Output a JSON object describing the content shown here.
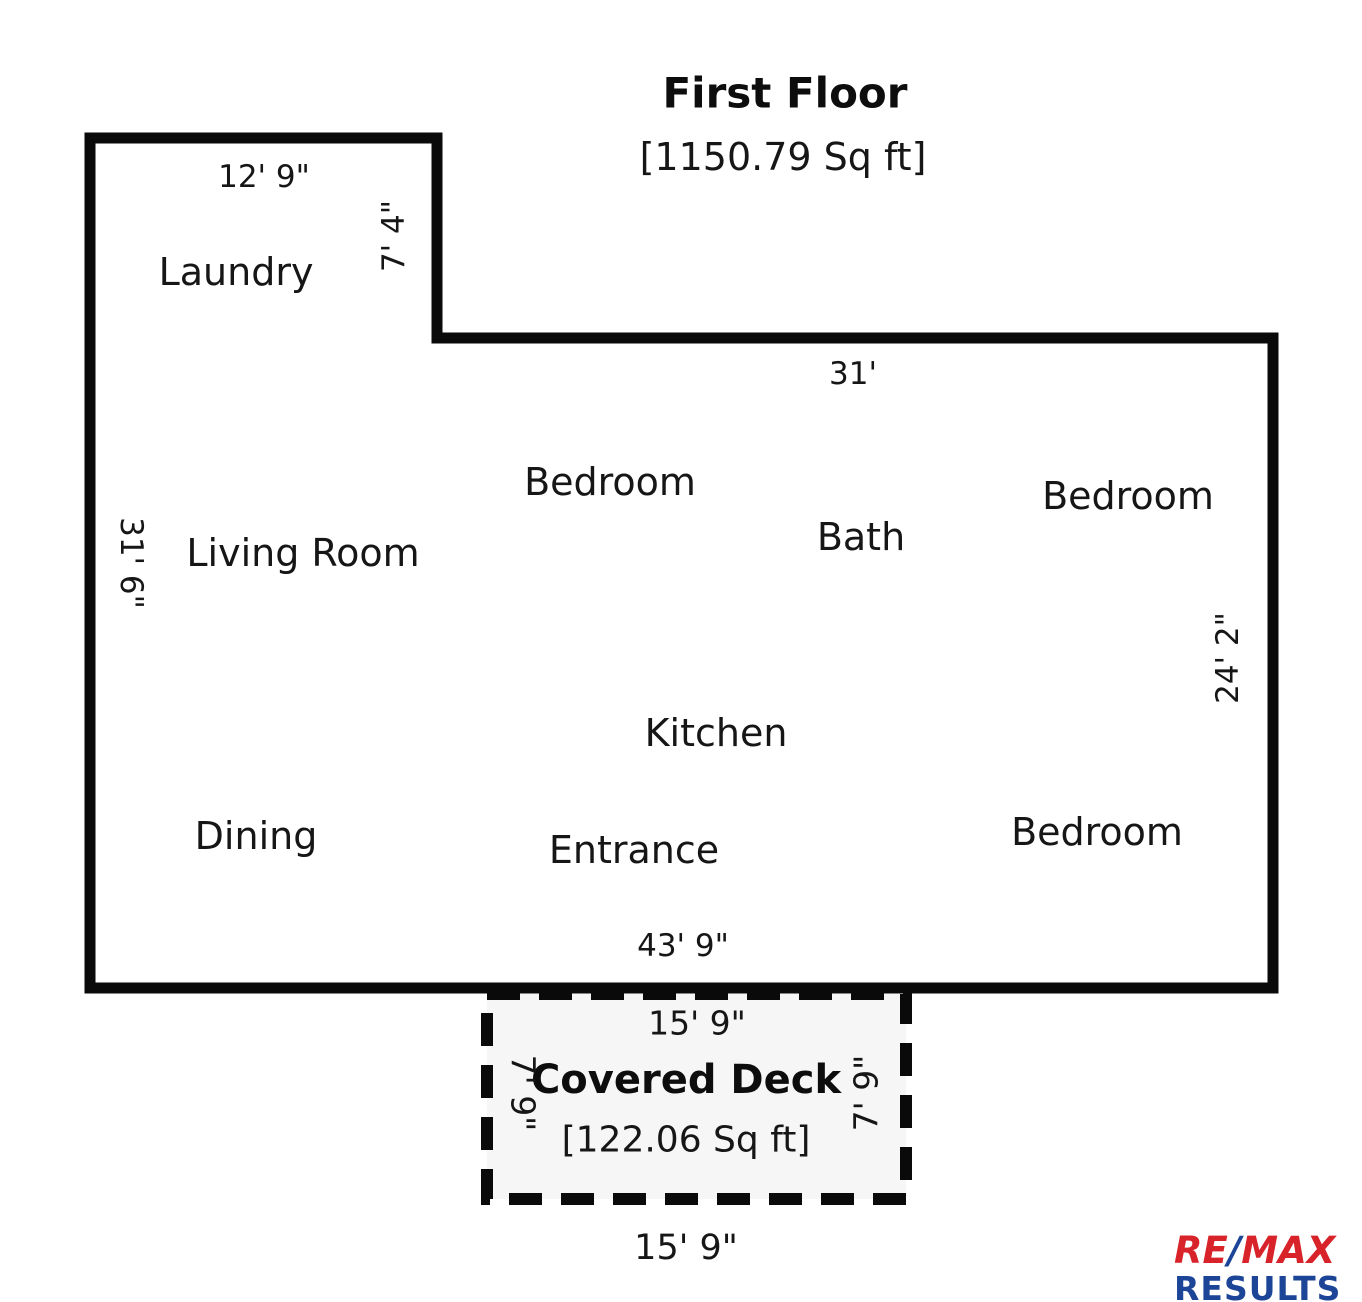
{
  "floor": {
    "title": "First Floor",
    "area": "[1150.79 Sq ft]"
  },
  "rooms": {
    "laundry": "Laundry",
    "living_room": "Living Room",
    "bedroom_top": "Bedroom",
    "bath": "Bath",
    "bedroom_right": "Bedroom",
    "kitchen": "Kitchen",
    "dining": "Dining",
    "entrance": "Entrance",
    "bedroom_bottom": "Bedroom"
  },
  "dimensions": {
    "laundry_width": "12' 9\"",
    "laundry_height": "7' 4\"",
    "top_width": "31'",
    "left_height": "31' 6\"",
    "right_height": "24' 2\"",
    "bottom_width": "43' 9\"",
    "deck_width_top": "15' 9\"",
    "deck_height_left": "7' 9\"",
    "deck_height_right": "7' 9\"",
    "deck_width_bottom": "15' 9\""
  },
  "deck": {
    "title": "Covered Deck",
    "area": "[122.06 Sq ft]"
  },
  "logo": {
    "re": "RE",
    "slash": "/",
    "max": "MAX",
    "results": "RESULTS"
  },
  "colors": {
    "wall": "#0a0a0a",
    "deck_fill": "#f6f6f6",
    "remax_red": "#d8232a",
    "remax_blue": "#1c4497"
  }
}
